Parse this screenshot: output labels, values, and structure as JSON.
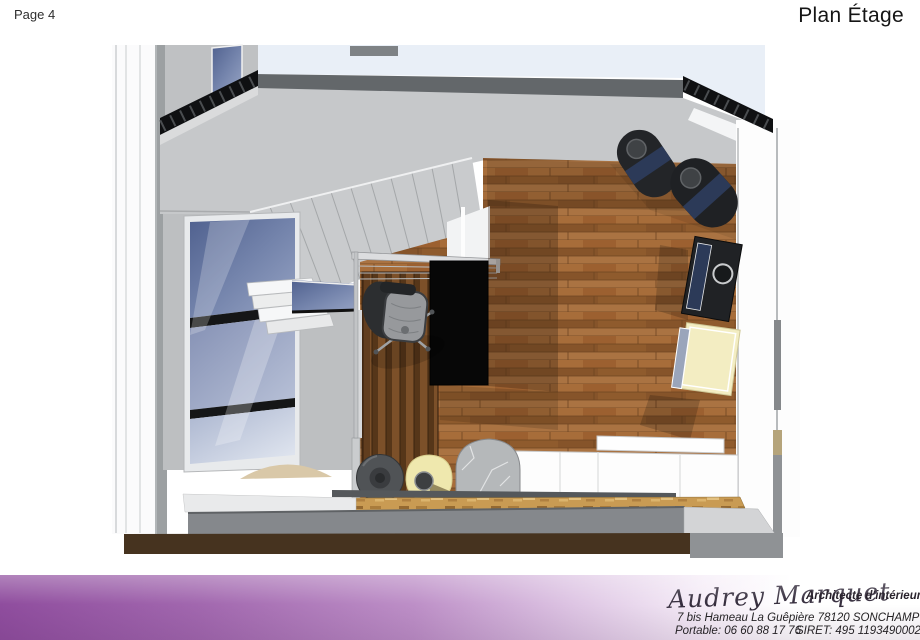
{
  "header": {
    "page_label": "Page 4",
    "title": "Plan Étage"
  },
  "footer": {
    "signature": "Audrey Marquet",
    "role": "Architecte d'intérieur",
    "address": "7 bis Hameau La Guêpière 78120 SONCHAMP",
    "phone": "Portable: 06 60 88 17 76",
    "siret": "SIRET: 495 11934900027"
  },
  "colors": {
    "band_purple": "#8f4d9e",
    "sky": "#e9eff7",
    "fascia": "#63676a",
    "attic_wall": "#c6c8ca",
    "wood_floor": "#9d6534",
    "desk": "#070707",
    "navy": "#2c3a58",
    "cream": "#f3edc2",
    "slab_gray": "#85888c",
    "dark_brown_band": "#46331f"
  }
}
